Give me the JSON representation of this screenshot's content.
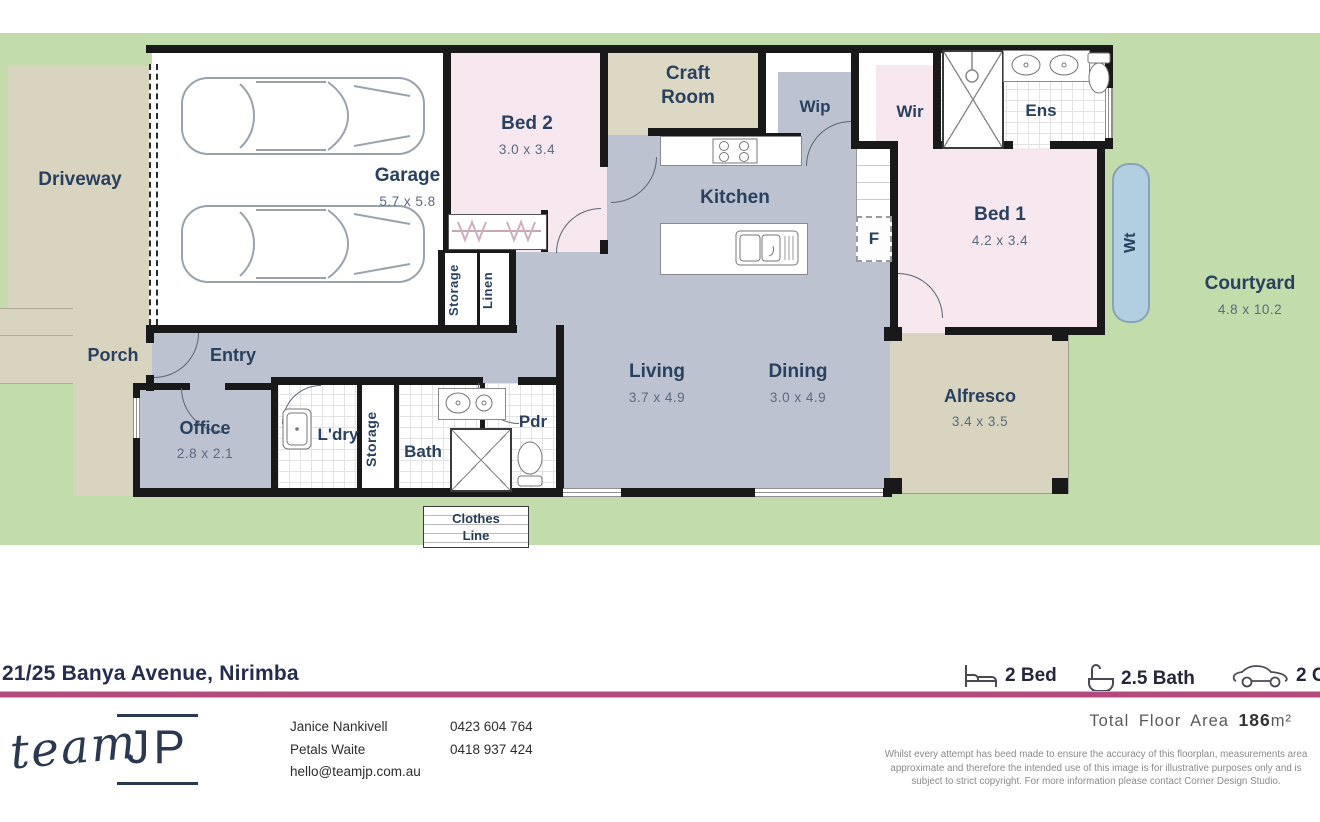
{
  "plan": {
    "driveway": {
      "label": "Driveway"
    },
    "garage": {
      "label": "Garage",
      "dims": "5.7 x 5.8"
    },
    "bed2": {
      "label": "Bed 2",
      "dims": "3.0  x 3.4"
    },
    "craft": {
      "label": "Craft Room"
    },
    "wip": {
      "label": "Wip"
    },
    "wir": {
      "label": "Wir"
    },
    "ens": {
      "label": "Ens"
    },
    "kitchen": {
      "label": "Kitchen"
    },
    "bed1": {
      "label": "Bed 1",
      "dims": "4.2  x 3.4"
    },
    "wt": {
      "label": "Wt"
    },
    "courtyard": {
      "label": "Courtyard",
      "dims": "4.8 x 10.2"
    },
    "porch": {
      "label": "Porch"
    },
    "entry": {
      "label": "Entry"
    },
    "office": {
      "label": "Office",
      "dims": "2.8  x 2.1"
    },
    "ldry": {
      "label": "L'dry"
    },
    "storage1": {
      "label": "Storage"
    },
    "bath": {
      "label": "Bath"
    },
    "pdr": {
      "label": "Pdr"
    },
    "living": {
      "label": "Living",
      "dims": "3.7  x 4.9"
    },
    "dining": {
      "label": "Dining",
      "dims": "3.0  x 4.9"
    },
    "alfresco": {
      "label": "Alfresco",
      "dims": "3.4 x 3.5"
    },
    "storage2": {
      "label": "Storage"
    },
    "linen": {
      "label": "Linen"
    },
    "fridge": {
      "label": "F"
    },
    "clothesline": {
      "line1": "Clothes",
      "line2": "Line"
    }
  },
  "info_bar": {
    "address": "21/25 Banya Avenue, Nirimba",
    "beds": "2 Bed",
    "baths": "2.5 Bath",
    "cars": "2 CAR"
  },
  "footer": {
    "logo_script": "team",
    "logo_initials": "JP",
    "agent1_name": "Janice Nankivell",
    "agent1_phone": "0423 604 764",
    "agent2_name": "Petals Waite",
    "agent2_phone": "0418 937 424",
    "email": "hello@teamjp.com.au",
    "total_area_label": "Total Floor Area",
    "total_area_value": "186",
    "total_area_unit": "m²",
    "disclaimer_line1": "Whilst every attempt has beed made to ensure the accuracy of this floorplan, measurements area",
    "disclaimer_line2": "approximate and therefore the intended use of this image is for illustrative purposes only and is",
    "disclaimer_line3": "subject to strict copyright. For more information please contact Corner Design Studio."
  },
  "colors": {
    "lot_green": "#c2dcab",
    "paving_beige": "#d9d4c0",
    "room_pink": "#f7e7ee",
    "room_gray": "#bcc2cf",
    "wall_black": "#191919",
    "tank_blue": "#b2cfe2",
    "accent_pink_line": "#b3497e",
    "label_navy": "#29415f"
  }
}
